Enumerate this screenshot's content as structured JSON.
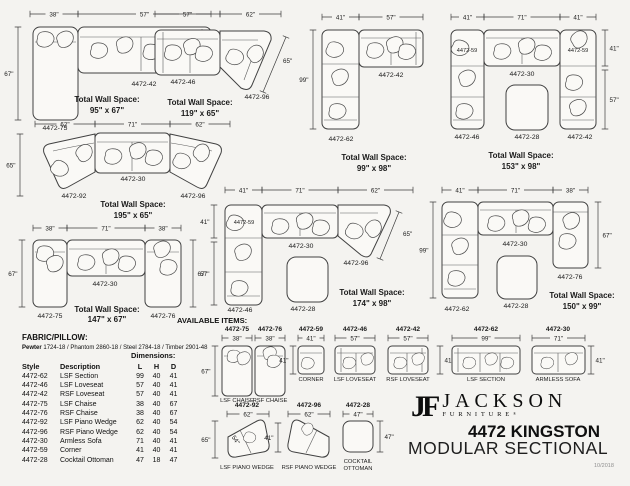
{
  "strings": {
    "total_label": "Total Wall Space:"
  },
  "configs": {
    "a": {
      "d1": "38\"",
      "d2": "57\"",
      "dv": "67\"",
      "p1": "4472-75",
      "p2": "4472-42",
      "tv": "95\" x 67\""
    },
    "b": {
      "d1": "57\"",
      "d2": "62\"",
      "dd": "65\"",
      "p1": "4472-46",
      "p2": "4472-96",
      "tv": "119\" x 65\""
    },
    "c": {
      "d1": "41\"",
      "d2": "57\"",
      "dv": "99\"",
      "p1": "4472-62",
      "p2": "4472-42",
      "tv": "99\" x 98\""
    },
    "d": {
      "d1": "41\"",
      "d2": "71\"",
      "d3": "41\"",
      "dv1": "41\"",
      "dv2": "57\"",
      "pc1": "4472-59",
      "pc2": "4472-59",
      "ps": "4472-30",
      "pl": "4472-46",
      "po": "4472-28",
      "pr": "4472-42",
      "tv": "153\" x 98\""
    },
    "e": {
      "d1": "62\"",
      "d2": "71\"",
      "d3": "62\"",
      "dv": "65\"",
      "p1": "4472-92",
      "p2": "4472-30",
      "p3": "4472-96",
      "tv": "195\" x 65\""
    },
    "f": {
      "d1": "41\"",
      "d2": "71\"",
      "d3": "62\"",
      "dv1": "41\"",
      "dv2": "57\"",
      "dd": "65\"",
      "pc": "4472-59",
      "ps": "4472-30",
      "pw": "4472-96",
      "pl": "4472-46",
      "po": "4472-28",
      "tv": "174\" x 98\""
    },
    "g": {
      "d1": "41\"",
      "d2": "71\"",
      "d3": "38\"",
      "dvl": "99\"",
      "dvr": "67\"",
      "p1": "4472-62",
      "p2": "4472-30",
      "p3": "4472-76",
      "po": "4472-28",
      "tv": "150\" x 99\""
    },
    "h": {
      "d1": "38\"",
      "d2": "71\"",
      "d3": "38\"",
      "dvl": "67\"",
      "dvr": "67\"",
      "p1": "4472-75",
      "p2": "4472-30",
      "p3": "4472-76",
      "tv": "147\" x 67\""
    }
  },
  "fabric": {
    "heading": "FABRIC/PILLOW:",
    "swatch": "Pewter",
    "rest": " 1724-18 / Phantom 2860-18 / Steel 2784-18 / Timber 2901-48"
  },
  "table": {
    "dimensions_label": "Dimensions:",
    "headers": {
      "style": "Style",
      "desc": "Description",
      "l": "L",
      "h": "H",
      "d": "D"
    },
    "rows": [
      [
        "4472-62",
        "LSF Section",
        "99",
        "40",
        "41"
      ],
      [
        "4472-46",
        "LSF Loveseat",
        "57",
        "40",
        "41"
      ],
      [
        "4472-42",
        "RSF Loveseat",
        "57",
        "40",
        "41"
      ],
      [
        "4472-75",
        "LSF Chaise",
        "38",
        "40",
        "67"
      ],
      [
        "4472-76",
        "RSF Chaise",
        "38",
        "40",
        "67"
      ],
      [
        "4472-92",
        "LSF Piano Wedge",
        "62",
        "40",
        "54"
      ],
      [
        "4472-96",
        "RSF Piano Wedge",
        "62",
        "40",
        "54"
      ],
      [
        "4472-30",
        "Armless Sofa",
        "71",
        "40",
        "41"
      ],
      [
        "4472-59",
        "Corner",
        "41",
        "40",
        "41"
      ],
      [
        "4472-28",
        "Cocktail Ottoman",
        "47",
        "18",
        "47"
      ]
    ]
  },
  "avail": {
    "heading": "AVAILABLE ITEMS:",
    "items": [
      {
        "style": "4472-75",
        "w": "38\"",
        "dvl": "67\"",
        "name": "LSF CHAISE"
      },
      {
        "style": "4472-76",
        "w": "38\"",
        "name": "RSF CHAISE"
      },
      {
        "style": "4472-59",
        "w": "41\"",
        "dvl": "41\"",
        "name": "CORNER"
      },
      {
        "style": "4472-46",
        "w": "57\"",
        "name": "LSF LOVESEAT"
      },
      {
        "style": "4472-42",
        "w": "57\"",
        "dvr": "41\"",
        "name": "RSF LOVESEAT"
      },
      {
        "style": "4472-62",
        "w": "99\"",
        "name": "LSF SECTION"
      },
      {
        "style": "4472-30",
        "w": "71\"",
        "dvr": "41\"",
        "name": "ARMLESS SOFA"
      },
      {
        "style": "4472-92",
        "w": "62\"",
        "dvl": "65\"",
        "diag": "54\"",
        "name": "LSF PIANO WEDGE"
      },
      {
        "style": "4472-96",
        "w": "62\"",
        "dvl": "41\"",
        "name": "RSF PIANO WEDGE"
      },
      {
        "style": "4472-28",
        "w": "47\"",
        "dvr": "47\"",
        "name1": "COCKTAIL",
        "name2": "OTTOMAN"
      }
    ]
  },
  "brand": {
    "monogram": "JF",
    "name": "JACKSON",
    "sub": "FURNITURE",
    "reg": "®",
    "title1": "4472 KINGSTON",
    "title2": "MODULAR SECTIONAL",
    "date": "10/2018"
  }
}
